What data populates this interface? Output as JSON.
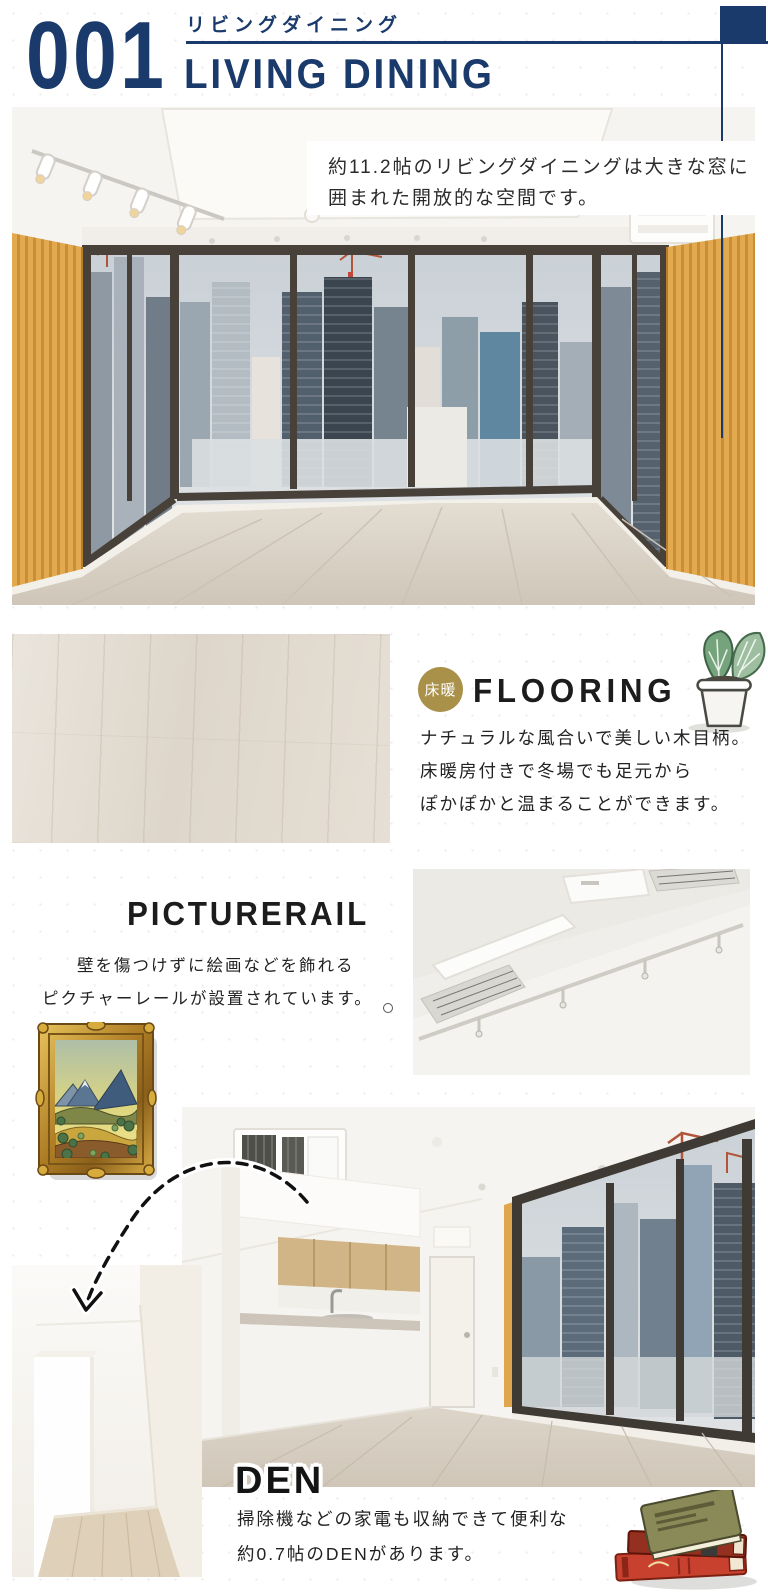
{
  "theme": {
    "navy": "#1a3a6c",
    "gold_badge": "#a9914a",
    "heading_text": "#1c1c1c",
    "body_text": "#2b2b2b",
    "background": "#ffffff"
  },
  "header": {
    "number": "001",
    "title_ja": "リビングダイニング",
    "title_en": "LIVING DINING"
  },
  "living": {
    "caption_lines": [
      "約11.2帖のリビングダイニングは大きな窓に",
      "囲まれた開放的な空間です。"
    ]
  },
  "flooring": {
    "badge": "床暖",
    "heading": "FLOORING",
    "desc_lines": [
      "ナチュラルな風合いで美しい木目柄。",
      "床暖房付きで冬場でも足元から",
      "ぽかぽかと温まることができます。"
    ]
  },
  "picturerail": {
    "heading": "PICTURERAIL",
    "desc_lines": [
      "壁を傷つけずに絵画などを飾れる",
      "ピクチャーレールが設置されています。"
    ]
  },
  "den": {
    "heading": "DEN",
    "desc_lines": [
      "掃除機などの家電も収納できて便利な",
      "約0.7帖のDENがあります。"
    ]
  },
  "illustrations": {
    "plant": "potted-plant",
    "frame": "framed-landscape-painting",
    "books": "stacked-books"
  }
}
